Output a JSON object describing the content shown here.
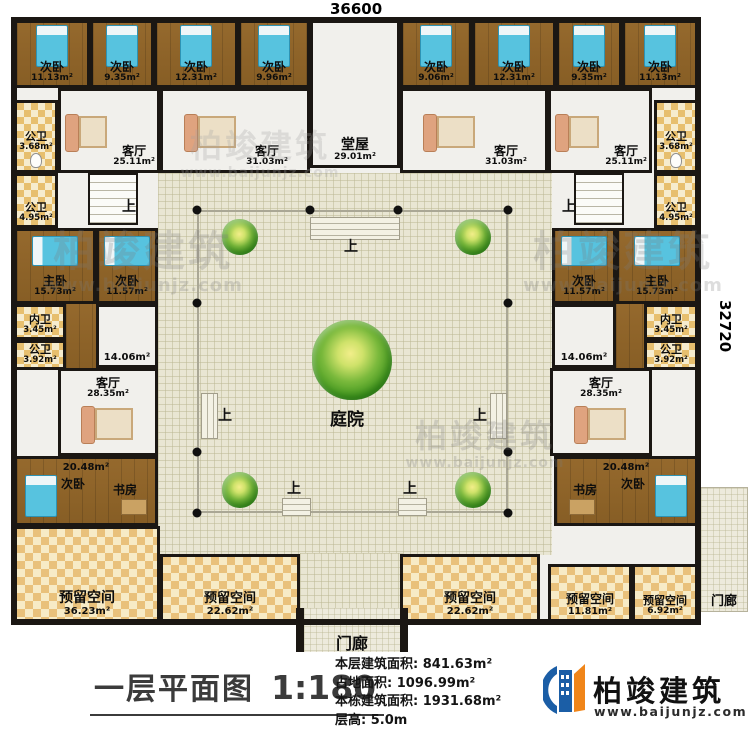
{
  "dimensions": {
    "top": "36600",
    "right": "32720"
  },
  "labels": {
    "up": "上"
  },
  "rooms": {
    "bed_t1": {
      "name": "次卧",
      "area": "11.13m²"
    },
    "bed_t2": {
      "name": "次卧",
      "area": "9.35m²"
    },
    "bed_t3": {
      "name": "次卧",
      "area": "12.31m²"
    },
    "bed_t4": {
      "name": "次卧",
      "area": "9.96m²"
    },
    "hall": {
      "name": "堂屋",
      "area": "29.01m²"
    },
    "bed_t5": {
      "name": "次卧",
      "area": "9.06m²"
    },
    "bed_t6": {
      "name": "次卧",
      "area": "12.31m²"
    },
    "bed_t7": {
      "name": "次卧",
      "area": "9.35m²"
    },
    "bed_t8": {
      "name": "次卧",
      "area": "11.13m²"
    },
    "bath_tl": {
      "name": "公卫",
      "area": "3.68m²"
    },
    "living_tl": {
      "name": "客厅",
      "area": "25.11m²"
    },
    "living_tl2": {
      "name": "客厅",
      "area": "31.03m²"
    },
    "living_tr2": {
      "name": "客厅",
      "area": "31.03m²"
    },
    "living_tr": {
      "name": "客厅",
      "area": "25.11m²"
    },
    "bath_tr": {
      "name": "公卫",
      "area": "3.68m²"
    },
    "bath_ml": {
      "name": "公卫",
      "area": "4.95m²"
    },
    "bath_mr": {
      "name": "公卫",
      "area": "4.95m²"
    },
    "master_l": {
      "name": "主卧",
      "area": "15.73m²"
    },
    "bed_ml": {
      "name": "次卧",
      "area": "11.57m²"
    },
    "bed_mr": {
      "name": "次卧",
      "area": "11.57m²"
    },
    "master_r": {
      "name": "主卧",
      "area": "15.73m²"
    },
    "wc_l": {
      "name": "内卫",
      "area": "3.45m²"
    },
    "bath_bl": {
      "name": "公卫",
      "area": "3.92m²"
    },
    "hall14_l": {
      "area": "14.06m²"
    },
    "hall14_r": {
      "area": "14.06m²"
    },
    "wc_r": {
      "name": "内卫",
      "area": "3.45m²"
    },
    "bath_br": {
      "name": "公卫",
      "area": "3.92m²"
    },
    "living_bl": {
      "name": "客厅",
      "area": "28.35m²"
    },
    "living_br": {
      "name": "客厅",
      "area": "28.35m²"
    },
    "suite_l": {
      "area": "20.48m²",
      "bedroom": "次卧",
      "study": "书房"
    },
    "suite_r": {
      "area": "20.48m²",
      "bedroom": "次卧",
      "study": "书房"
    },
    "res_1": {
      "name": "预留空间",
      "area": "36.23m²"
    },
    "res_2": {
      "name": "预留空间",
      "area": "22.62m²"
    },
    "res_3": {
      "name": "预留空间",
      "area": "22.62m²"
    },
    "res_4": {
      "name": "预留空间",
      "area": "11.81m²"
    },
    "res_5": {
      "name": "预留空间",
      "area": "6.92m²"
    },
    "courtyard": {
      "name": "庭院"
    },
    "porch_bottom": {
      "name": "门廊"
    },
    "porch_right": {
      "name": "门廊"
    }
  },
  "titleblock": {
    "title": "一层平面图",
    "scale": "1:180",
    "stats": [
      {
        "label": "本层建筑面积:",
        "value": "841.63m²"
      },
      {
        "label": "占地面积:",
        "value": "1096.99m²"
      },
      {
        "label": "本栋建筑面积:",
        "value": "1931.68m²"
      },
      {
        "label": "层高:",
        "value": "5.0m"
      }
    ]
  },
  "logo": {
    "name": "柏竣建筑",
    "url": "www.baijunjz.com"
  },
  "watermark": {
    "brand": "柏竣建筑",
    "url": "www.baijunjz.com"
  },
  "colors": {
    "wall": "#1b1713",
    "wood_floor": "#8d6428",
    "bed_blue": "#57c3df",
    "tile_tan": "#e7bf6e",
    "reserved_tan": "#e9c17b",
    "courtyard_floor": "#e9e6d3",
    "logo_blue": "#1b5ea6",
    "logo_orange": "#f08519"
  }
}
